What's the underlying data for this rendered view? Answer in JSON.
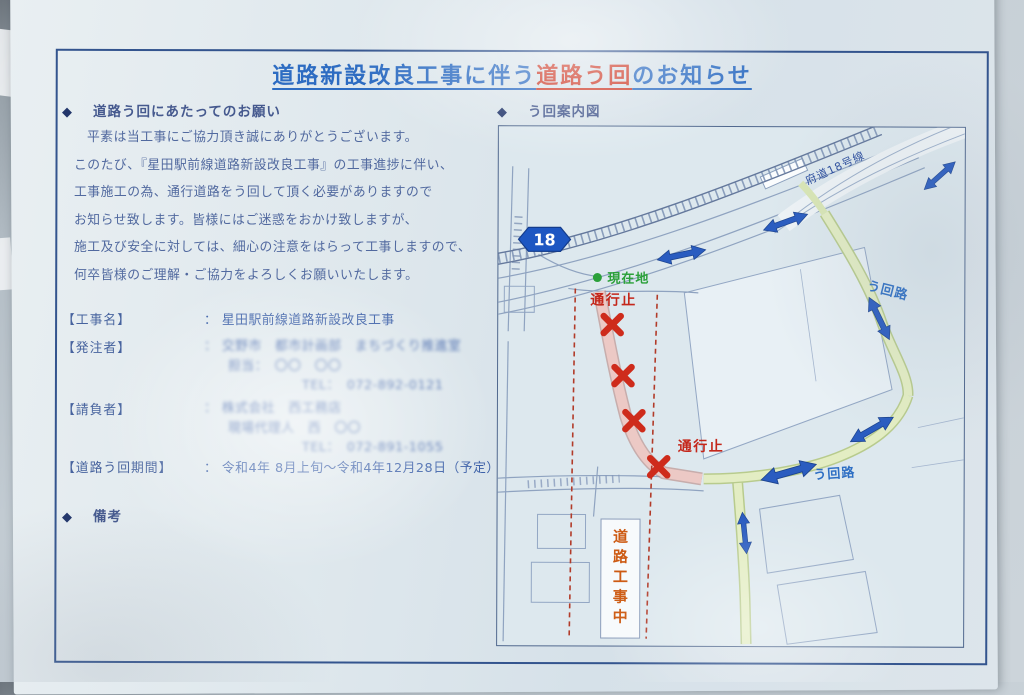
{
  "notice": {
    "bullet": "◆",
    "title": {
      "prefix": "道路新設改良工事に伴う",
      "emphasis": "道路う回",
      "suffix": "のお知らせ"
    },
    "request": {
      "heading": "道路う回にあたってのお願い",
      "lines": [
        "平素は当工事にご協力頂き誠にありがとうございます。",
        "このたび、『星田駅前線道路新設改良工事』の工事進捗に伴い、",
        "工事施工の為、通行道路をう回して頂く必要がありますので",
        "お知らせ致します。皆様にはご迷惑をおかけ致しますが、",
        "施工及び安全に対しては、細心の注意をはらって工事しますので、",
        "何卒皆様のご理解・ご協力をよろしくお願いいたします。"
      ]
    },
    "fields": {
      "project": {
        "label": "【工事名】",
        "value": "： 星田駅前線道路新設改良工事"
      },
      "client": {
        "label": "【発注者】",
        "line1": "： 交野市　都市計画部　まちづくり推進室",
        "line2": "担当：　〇〇　〇〇",
        "line3": "TEL：　072-892-0121"
      },
      "contractor": {
        "label": "【請負者】",
        "line1": "： 株式会社　西工務店",
        "line2": "現場代理人　西　〇〇",
        "line3": "TEL：　072-891-1055"
      },
      "period": {
        "label": "【道路う回期間】",
        "value": "： 令和4年 8月上旬～令和4年12月28日（予定）"
      }
    },
    "remarks_heading": "備考"
  },
  "map": {
    "heading": "う回案内図",
    "route_shield": "18",
    "route_name": "府道18号線",
    "current_location": "現在地",
    "road_closed_1": "通行止",
    "road_closed_2": "通行止",
    "detour_1": "う回路",
    "detour_2": "う回路",
    "under_construction": "道路工事中"
  },
  "colors": {
    "title_blue": "#2d6cc2",
    "alert_red": "#cd3a28",
    "detour_arrow_blue": "#2a5cc0",
    "current_green": "#2ba03a",
    "construction_orange": "#cd5a12",
    "frame_navy": "#33548e"
  }
}
